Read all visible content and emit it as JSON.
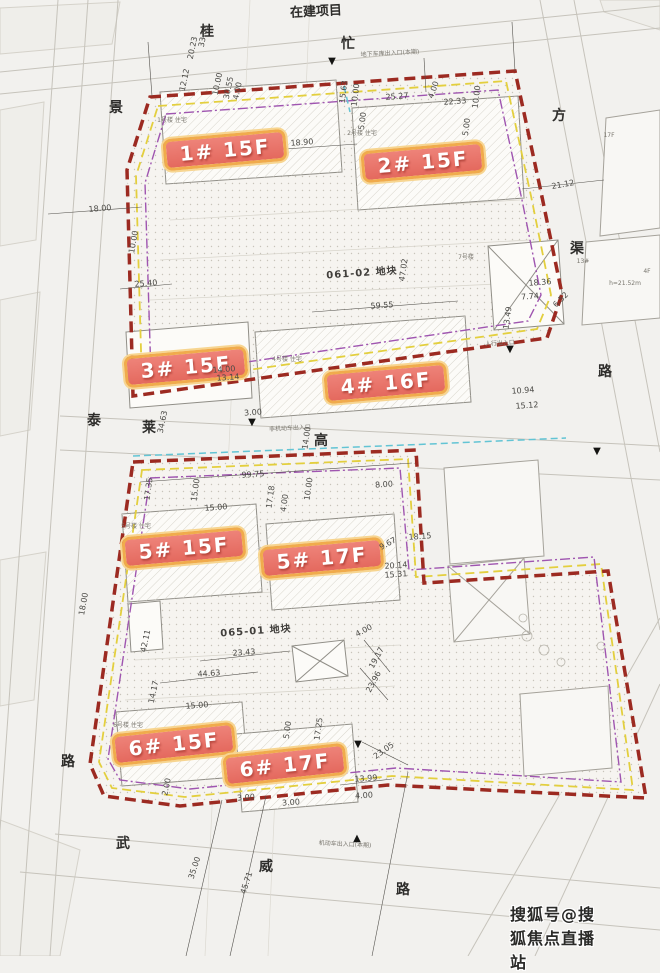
{
  "watermark": {
    "text": "搜狐号@搜狐焦点直播站"
  },
  "colors": {
    "paper": "#f2f1ee",
    "boundary_red": "#9c2a21",
    "badge_bg": "#e97b6f",
    "badge_border": "#f0ab4c",
    "yellow_line": "#e3cf3e",
    "purple_line": "#9f55b0",
    "cyan_line": "#62c4d4"
  },
  "building_badges": [
    {
      "label": "1# 15F",
      "cx": 225,
      "cy": 150,
      "rot": -5
    },
    {
      "label": "2# 15F",
      "cx": 423,
      "cy": 162,
      "rot": -5
    },
    {
      "label": "3# 15F",
      "cx": 186,
      "cy": 367,
      "rot": -5
    },
    {
      "label": "4# 16F",
      "cx": 386,
      "cy": 383,
      "rot": -5
    },
    {
      "label": "5# 15F",
      "cx": 184,
      "cy": 548,
      "rot": -5
    },
    {
      "label": "5# 17F",
      "cx": 322,
      "cy": 558,
      "rot": -5
    },
    {
      "label": "6# 15F",
      "cx": 174,
      "cy": 744,
      "rot": -6
    },
    {
      "label": "6# 17F",
      "cx": 285,
      "cy": 765,
      "rot": -6
    }
  ],
  "parcel_labels": [
    {
      "text": "061-02 地块",
      "cx": 362,
      "cy": 274,
      "rot": -4
    },
    {
      "text": "065-01 地块",
      "cx": 256,
      "cy": 632,
      "rot": -4
    }
  ],
  "road_labels": [
    {
      "text": "在建项目",
      "cx": 316,
      "cy": 12,
      "rot": -3,
      "size": 13
    },
    {
      "text": "桂",
      "cx": 207,
      "cy": 32
    },
    {
      "text": "忙",
      "cx": 348,
      "cy": 44
    },
    {
      "text": "景",
      "cx": 116,
      "cy": 108
    },
    {
      "text": "方",
      "cx": 559,
      "cy": 116
    },
    {
      "text": "渠",
      "cx": 577,
      "cy": 249
    },
    {
      "text": "路",
      "cx": 605,
      "cy": 372
    },
    {
      "text": "泰",
      "cx": 94,
      "cy": 421
    },
    {
      "text": "莱",
      "cx": 149,
      "cy": 428
    },
    {
      "text": "高",
      "cx": 321,
      "cy": 441
    },
    {
      "text": "路",
      "cx": 68,
      "cy": 762
    },
    {
      "text": "武",
      "cx": 123,
      "cy": 844
    },
    {
      "text": "威",
      "cx": 266,
      "cy": 867
    },
    {
      "text": "路",
      "cx": 403,
      "cy": 890
    }
  ],
  "dimensions": [
    {
      "text": "33.03",
      "cx": 204,
      "cy": 36,
      "rot": -78
    },
    {
      "text": "20.23",
      "cx": 193,
      "cy": 48,
      "rot": -78
    },
    {
      "text": "12.12",
      "cx": 185,
      "cy": 80,
      "rot": -78
    },
    {
      "text": "10.00",
      "cx": 218,
      "cy": 84,
      "rot": -78
    },
    {
      "text": "30.55",
      "cx": 229,
      "cy": 88,
      "rot": -78
    },
    {
      "text": "4.00",
      "cx": 238,
      "cy": 91,
      "rot": -78
    },
    {
      "text": "15.63",
      "cx": 344,
      "cy": 92,
      "rot": -83
    },
    {
      "text": "10.00",
      "cx": 356,
      "cy": 95,
      "rot": -83
    },
    {
      "text": "5.00",
      "cx": 363,
      "cy": 121,
      "rot": -83
    },
    {
      "text": "25.27",
      "cx": 397,
      "cy": 97,
      "rot": -4
    },
    {
      "text": "4.00",
      "cx": 434,
      "cy": 90,
      "rot": -70
    },
    {
      "text": "22.33",
      "cx": 455,
      "cy": 102,
      "rot": -4
    },
    {
      "text": "10.00",
      "cx": 477,
      "cy": 97,
      "rot": -83
    },
    {
      "text": "5.00",
      "cx": 467,
      "cy": 127,
      "rot": -83
    },
    {
      "text": "18.90",
      "cx": 302,
      "cy": 143,
      "rot": -4
    },
    {
      "text": "21.12",
      "cx": 563,
      "cy": 185,
      "rot": -10
    },
    {
      "text": "18.00",
      "cx": 100,
      "cy": 209,
      "rot": -5
    },
    {
      "text": "10.00",
      "cx": 134,
      "cy": 242,
      "rot": -80
    },
    {
      "text": "25.40",
      "cx": 146,
      "cy": 284,
      "rot": -4
    },
    {
      "text": "59.55",
      "cx": 382,
      "cy": 306,
      "rot": -4
    },
    {
      "text": "47.02",
      "cx": 404,
      "cy": 270,
      "rot": -82
    },
    {
      "text": "18.36",
      "cx": 540,
      "cy": 283,
      "rot": -4
    },
    {
      "text": "7.74",
      "cx": 530,
      "cy": 297,
      "rot": -4
    },
    {
      "text": "6.52",
      "cx": 561,
      "cy": 300,
      "rot": -45
    },
    {
      "text": "13.49",
      "cx": 508,
      "cy": 318,
      "rot": -82
    },
    {
      "text": "14.00",
      "cx": 224,
      "cy": 370,
      "rot": -4
    },
    {
      "text": "13.14",
      "cx": 228,
      "cy": 378,
      "rot": -4
    },
    {
      "text": "10.94",
      "cx": 523,
      "cy": 391,
      "rot": -4
    },
    {
      "text": "15.12",
      "cx": 527,
      "cy": 406,
      "rot": -4
    },
    {
      "text": "34.63",
      "cx": 163,
      "cy": 422,
      "rot": -78
    },
    {
      "text": "3.00",
      "cx": 253,
      "cy": 413,
      "rot": -4
    },
    {
      "text": "14.00",
      "cx": 307,
      "cy": 438,
      "rot": -82
    },
    {
      "text": "99.75",
      "cx": 253,
      "cy": 475,
      "rot": -4
    },
    {
      "text": "17.35",
      "cx": 149,
      "cy": 489,
      "rot": -82
    },
    {
      "text": "15.00",
      "cx": 196,
      "cy": 490,
      "rot": -82
    },
    {
      "text": "17.18",
      "cx": 271,
      "cy": 497,
      "rot": -82
    },
    {
      "text": "4.00",
      "cx": 285,
      "cy": 503,
      "rot": -82
    },
    {
      "text": "10.00",
      "cx": 309,
      "cy": 489,
      "rot": -82
    },
    {
      "text": "15.00",
      "cx": 216,
      "cy": 508,
      "rot": -4
    },
    {
      "text": "8.00",
      "cx": 384,
      "cy": 485,
      "rot": -4
    },
    {
      "text": "9.67",
      "cx": 388,
      "cy": 544,
      "rot": -28
    },
    {
      "text": "18.15",
      "cx": 420,
      "cy": 537,
      "rot": -4
    },
    {
      "text": "20.14",
      "cx": 396,
      "cy": 566,
      "rot": -4
    },
    {
      "text": "15.31",
      "cx": 396,
      "cy": 575,
      "rot": -4
    },
    {
      "text": "18.00",
      "cx": 84,
      "cy": 604,
      "rot": -80
    },
    {
      "text": "42.11",
      "cx": 146,
      "cy": 641,
      "rot": -78
    },
    {
      "text": "23.43",
      "cx": 244,
      "cy": 653,
      "rot": -4
    },
    {
      "text": "4.00",
      "cx": 364,
      "cy": 631,
      "rot": -28
    },
    {
      "text": "19.17",
      "cx": 377,
      "cy": 658,
      "rot": -62
    },
    {
      "text": "44.63",
      "cx": 209,
      "cy": 674,
      "rot": -4
    },
    {
      "text": "23.96",
      "cx": 374,
      "cy": 682,
      "rot": -62
    },
    {
      "text": "14.17",
      "cx": 154,
      "cy": 692,
      "rot": -78
    },
    {
      "text": "15.00",
      "cx": 197,
      "cy": 706,
      "rot": -4
    },
    {
      "text": "5.00",
      "cx": 288,
      "cy": 730,
      "rot": -82
    },
    {
      "text": "17.25",
      "cx": 319,
      "cy": 729,
      "rot": -82
    },
    {
      "text": "23.05",
      "cx": 384,
      "cy": 751,
      "rot": -35
    },
    {
      "text": "13.99",
      "cx": 366,
      "cy": 779,
      "rot": -4
    },
    {
      "text": "4.00",
      "cx": 364,
      "cy": 796,
      "rot": -4
    },
    {
      "text": "3.00",
      "cx": 246,
      "cy": 798,
      "rot": -4
    },
    {
      "text": "3.00",
      "cx": 291,
      "cy": 803,
      "rot": -4
    },
    {
      "text": "2.00",
      "cx": 167,
      "cy": 787,
      "rot": -78
    },
    {
      "text": "35.00",
      "cx": 195,
      "cy": 868,
      "rot": -72
    },
    {
      "text": "45.71",
      "cx": 247,
      "cy": 883,
      "rot": -72
    }
  ],
  "tiny_labels": [
    {
      "text": "1号楼 住宅",
      "cx": 172,
      "cy": 121
    },
    {
      "text": "2号楼 住宅",
      "cx": 362,
      "cy": 134
    },
    {
      "text": "7号楼",
      "cx": 466,
      "cy": 258
    },
    {
      "text": "4号楼 住宅",
      "cx": 287,
      "cy": 360
    },
    {
      "text": "5号楼 住宅",
      "cx": 136,
      "cy": 527
    },
    {
      "text": "6号楼 住宅",
      "cx": 128,
      "cy": 726
    },
    {
      "text": "17F",
      "cx": 609,
      "cy": 136
    },
    {
      "text": "13#",
      "cx": 583,
      "cy": 262
    },
    {
      "text": "4F",
      "cx": 647,
      "cy": 272
    },
    {
      "text": "h=21.52m",
      "cx": 625,
      "cy": 284
    },
    {
      "text": "地下车库出入口(本期)",
      "cx": 390,
      "cy": 54,
      "rot": -3
    },
    {
      "text": "人行出入口",
      "cx": 500,
      "cy": 344,
      "rot": -3
    },
    {
      "text": "非机动车出入口",
      "cx": 290,
      "cy": 429,
      "rot": -3
    },
    {
      "text": "机动车出入口(本期)",
      "cx": 345,
      "cy": 845,
      "rot": 3
    }
  ],
  "markers": [
    {
      "text": "▼",
      "cx": 332,
      "cy": 62
    },
    {
      "text": "▼",
      "cx": 252,
      "cy": 423
    },
    {
      "text": "▼",
      "cx": 510,
      "cy": 350
    },
    {
      "text": "▼",
      "cx": 597,
      "cy": 452
    },
    {
      "text": "▼",
      "cx": 358,
      "cy": 745
    },
    {
      "text": "▲",
      "cx": 357,
      "cy": 839
    }
  ]
}
